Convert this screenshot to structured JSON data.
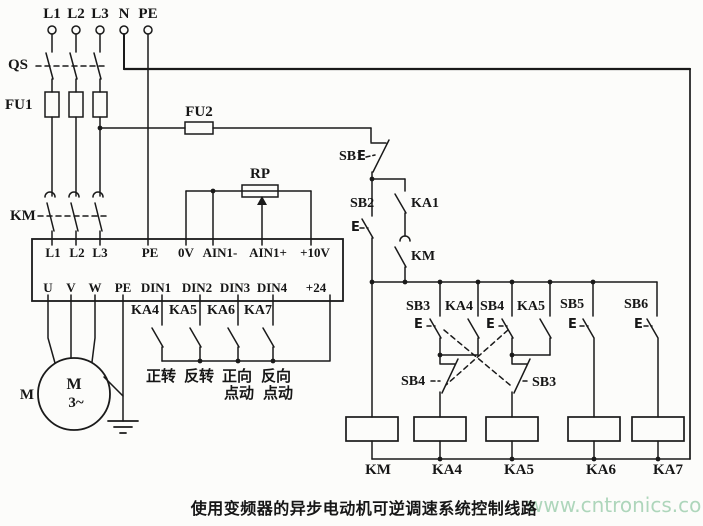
{
  "page": {
    "caption": "使用变频器的异步电动机可逆调速系统控制线路",
    "watermark": "www.cntronics.com"
  },
  "power": {
    "terminals": [
      "L1",
      "L2",
      "L3",
      "N",
      "PE"
    ],
    "qs": "QS",
    "fu1": "FU1",
    "fu2": "FU2",
    "km": "KM"
  },
  "inverter": {
    "top_terminals": [
      "L1",
      "L2",
      "L3",
      "PE",
      "0V",
      "AIN1-",
      "AIN1+",
      "+10V"
    ],
    "bottom_terminals": [
      "U",
      "V",
      "W",
      "PE",
      "DIN1",
      "DIN2",
      "DIN3",
      "DIN4",
      "+24"
    ]
  },
  "rp": {
    "label": "RP"
  },
  "motor": {
    "outer_label": "M",
    "symbol": "M",
    "phase": "3~"
  },
  "relay_contacts": [
    "KA4",
    "KA5",
    "KA6",
    "KA7"
  ],
  "function_labels": [
    "正转",
    "反转",
    "正向",
    "点动",
    "反向",
    "点动"
  ],
  "control": {
    "sb1": "SB1",
    "sb2": "SB2",
    "ka1": "KA1",
    "km_aux": "KM",
    "sb3": "SB3",
    "ka4": "KA4",
    "sb4": "SB4",
    "ka5": "KA5",
    "sb5": "SB5",
    "sb6": "SB6",
    "sb4_nc": "SB4",
    "sb3_nc": "SB3",
    "button_actuator": "E"
  },
  "coils": [
    "KM",
    "KA4",
    "KA5",
    "KA6",
    "KA7"
  ]
}
